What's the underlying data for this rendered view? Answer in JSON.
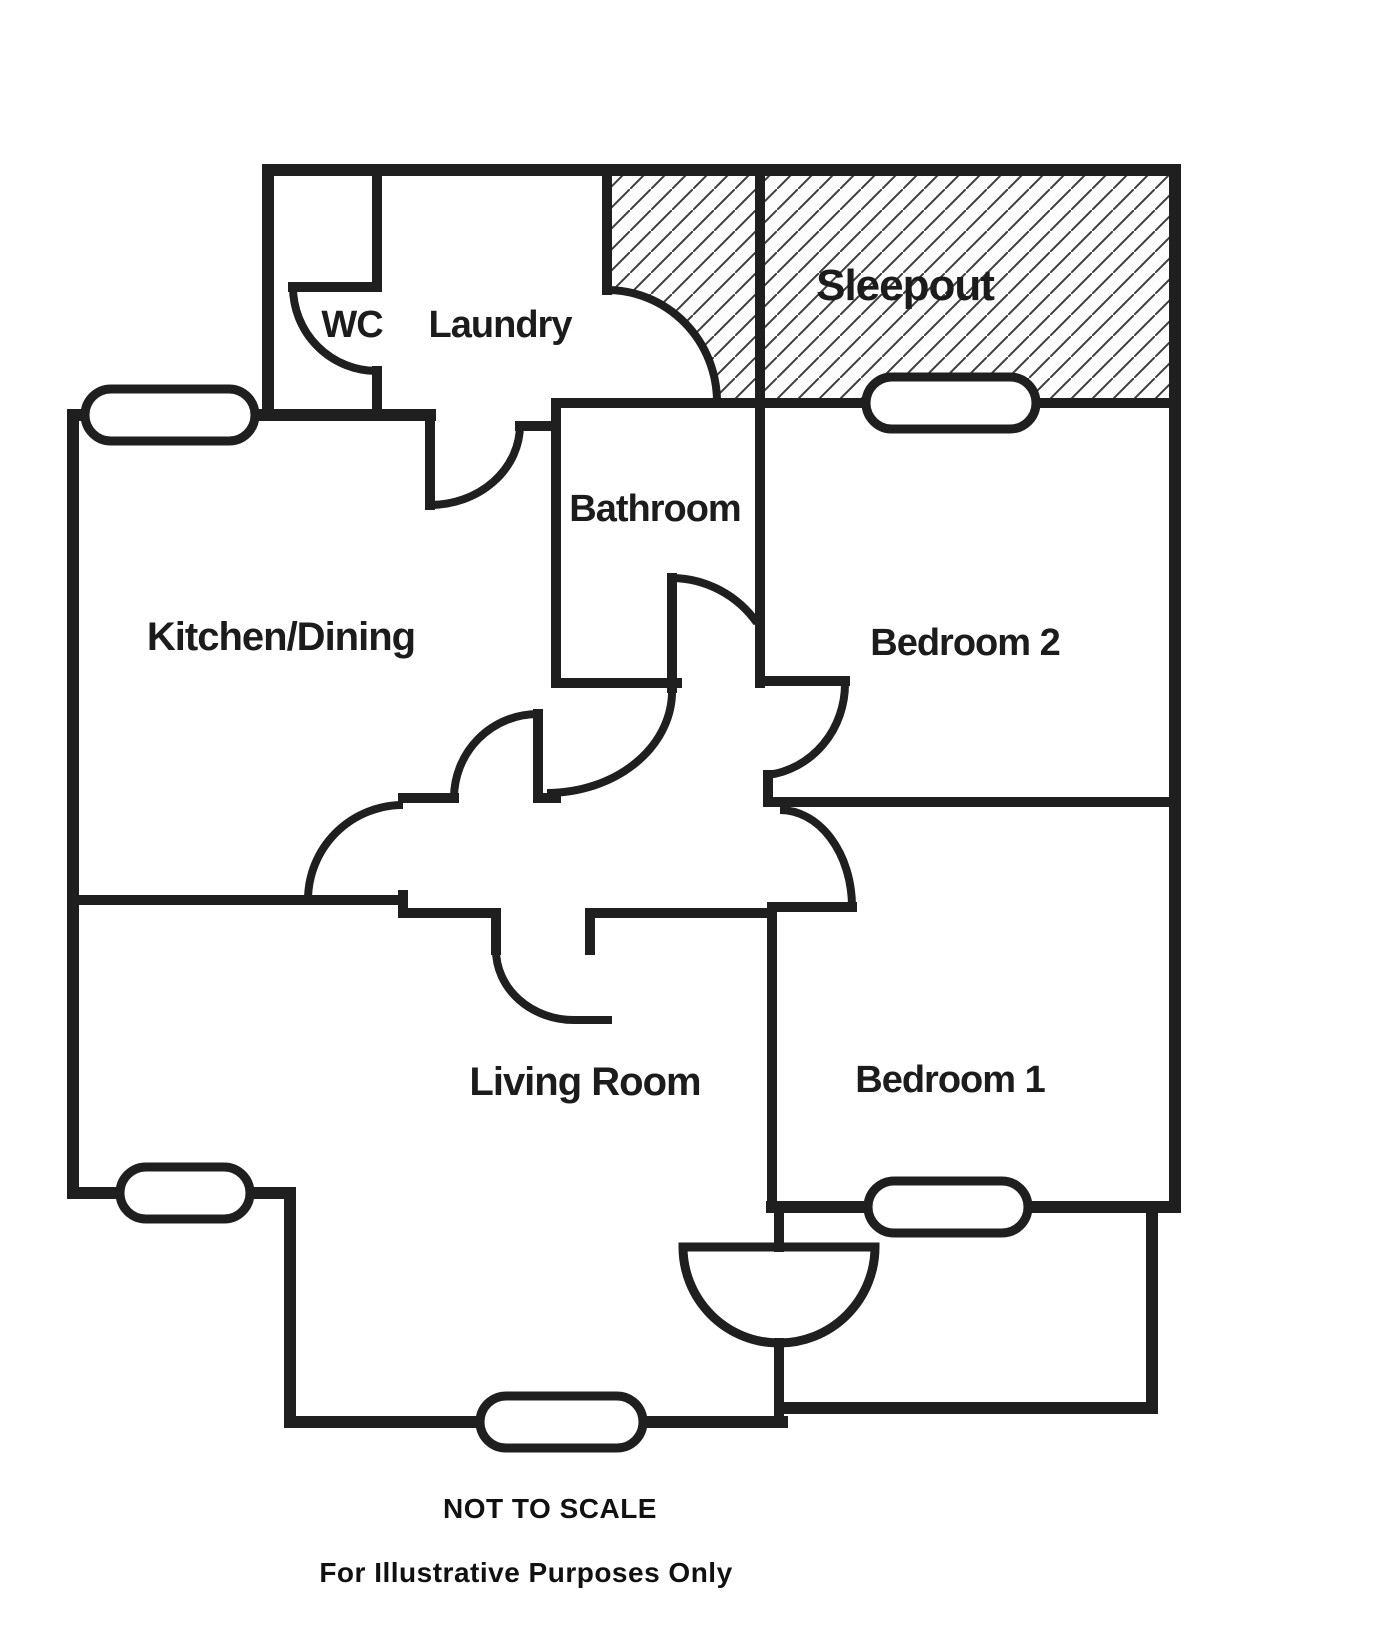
{
  "plan": {
    "type": "residential-floor-plan",
    "rooms": {
      "wc": {
        "label": "WC"
      },
      "laundry": {
        "label": "Laundry"
      },
      "sleepout": {
        "label": "Sleepout",
        "hatched": true
      },
      "bathroom": {
        "label": "Bathroom"
      },
      "kitchen_dining": {
        "label": "Kitchen/Dining"
      },
      "bedroom2": {
        "label": "Bedroom 2"
      },
      "living_room": {
        "label": "Living Room"
      },
      "bedroom1": {
        "label": "Bedroom 1"
      }
    },
    "window_count": 5,
    "colors": {
      "wall": "#1f1f1f",
      "hatch_line": "#3d3d3d",
      "background": "#ffffff",
      "text": "#1c1c1c"
    }
  },
  "footer": {
    "not_to_scale": "NOT TO SCALE",
    "disclaimer": "For Illustrative Purposes Only"
  }
}
